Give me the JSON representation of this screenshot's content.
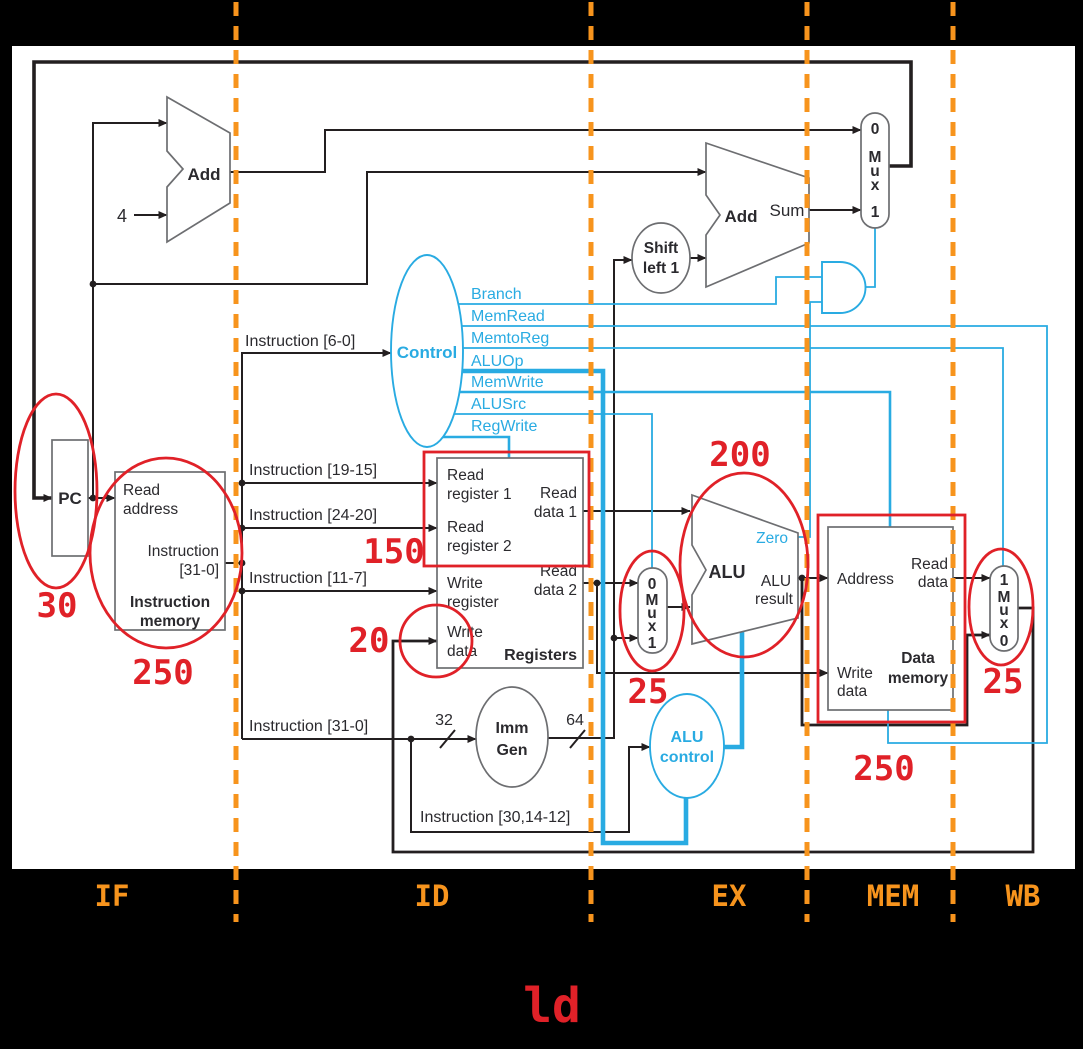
{
  "instruction_label": "ld",
  "stage_labels": [
    "IF",
    "ID",
    "EX",
    "MEM",
    "WB"
  ],
  "latencies": {
    "pc": "30",
    "instruction_memory": "250",
    "register_read": "150",
    "register_write": "20",
    "alusrc_mux": "25",
    "alu": "200",
    "data_memory": "250",
    "memtoreg_mux": "25"
  },
  "components": {
    "pc": {
      "label": "PC"
    },
    "instruction_memory": {
      "read_address": [
        "Read",
        "address"
      ],
      "instruction_out": [
        "Instruction",
        "[31-0]"
      ],
      "name": [
        "Instruction",
        "memory"
      ]
    },
    "pc_adder": {
      "label": "Add",
      "constant": "4"
    },
    "branch_adder": {
      "label": "Add",
      "output": "Sum"
    },
    "shift_left": {
      "label": [
        "Shift",
        "left 1"
      ]
    },
    "control": {
      "label": "Control",
      "outputs": [
        "Branch",
        "MemRead",
        "MemtoReg",
        "ALUOp",
        "MemWrite",
        "ALUSrc",
        "RegWrite"
      ]
    },
    "registers": {
      "name": "Registers",
      "read_register_1": [
        "Read",
        "register 1"
      ],
      "read_register_2": [
        "Read",
        "register 2"
      ],
      "write_register": [
        "Write",
        "register"
      ],
      "write_data": [
        "Write",
        "data"
      ],
      "read_data_1": [
        "Read",
        "data 1"
      ],
      "read_data_2": [
        "Read",
        "data 2"
      ]
    },
    "imm_gen": {
      "label": [
        "Imm",
        "Gen"
      ],
      "input_width": "32",
      "output_width": "64"
    },
    "alu": {
      "label": "ALU",
      "zero": "Zero",
      "result": [
        "ALU",
        "result"
      ]
    },
    "alu_control": {
      "label": [
        "ALU",
        "control"
      ]
    },
    "data_memory": {
      "address": "Address",
      "read_data": [
        "Read",
        "data"
      ],
      "write_data": [
        "Write",
        "data"
      ],
      "name": [
        "Data",
        "memory"
      ]
    },
    "pcsrc_mux": {
      "labels": [
        "0",
        "M",
        "u",
        "x",
        "1"
      ]
    },
    "alusrc_mux": {
      "labels": [
        "0",
        "M",
        "u",
        "x",
        "1"
      ]
    },
    "memtoreg_mux": {
      "labels": [
        "1",
        "M",
        "u",
        "x",
        "0"
      ]
    }
  },
  "instruction_fields": {
    "opcode": "Instruction [6-0]",
    "rs1": "Instruction [19-15]",
    "rs2": "Instruction [24-20]",
    "rd": "Instruction [11-7]",
    "full": "Instruction [31-0]",
    "funct": "Instruction [30,14-12]"
  },
  "colors": {
    "control_signal_blue": "#29abe2",
    "annotation_red": "#e02128",
    "stage_orange": "#f7941d"
  }
}
